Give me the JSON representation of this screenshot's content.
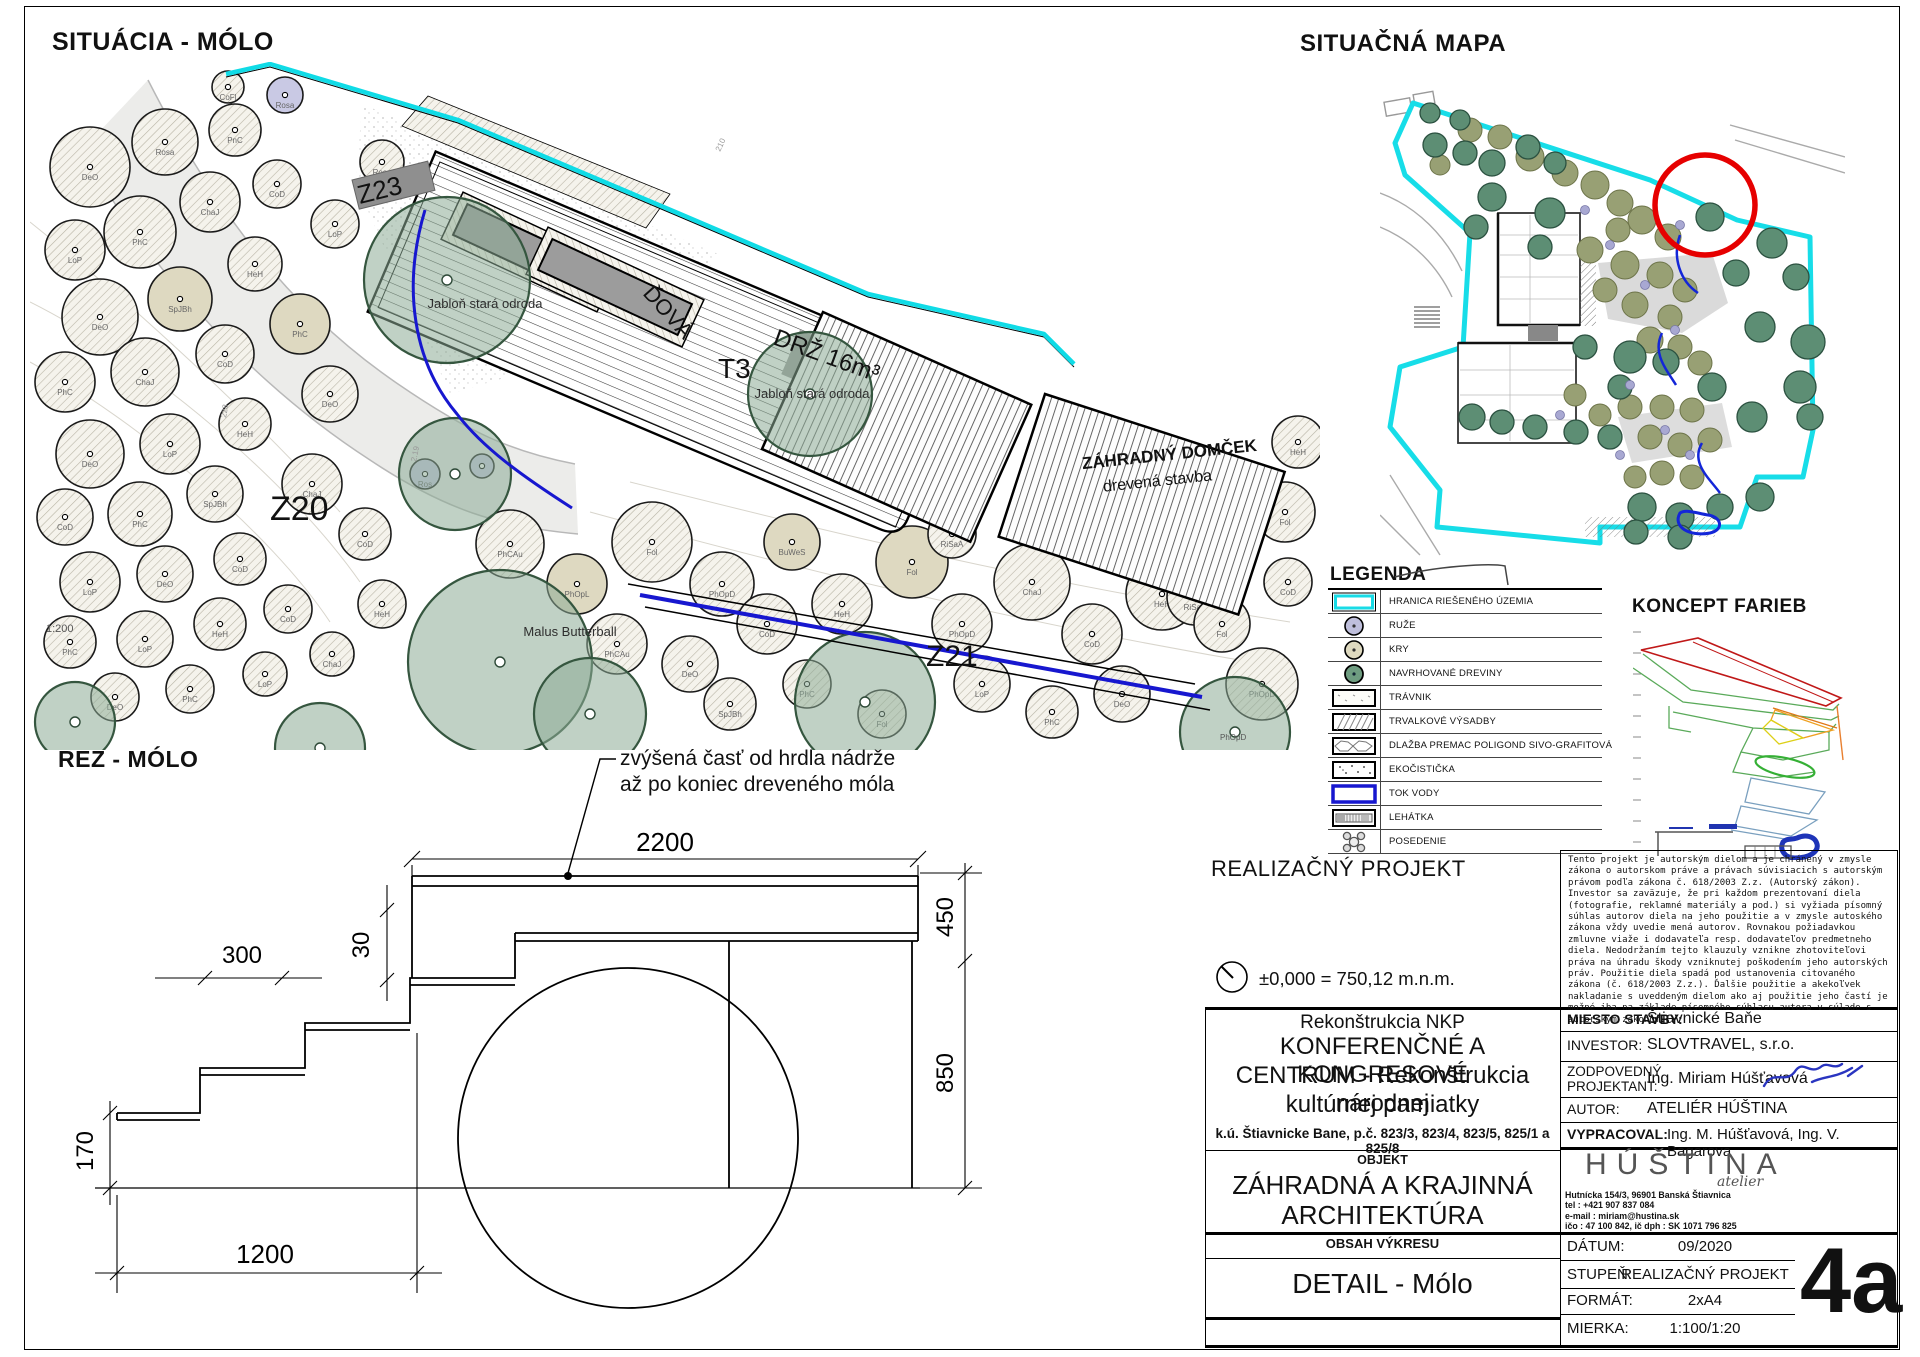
{
  "page": {
    "title_situacia": "SITUÁCIA - MÓLO",
    "title_mapa": "SITUAČNÁ MAPA",
    "title_rez": "REZ - MÓLO",
    "title_legenda": "LEGENDA",
    "title_koncept": "KONCEPT FARIEB"
  },
  "legend": {
    "items": [
      {
        "type": "boundary",
        "icon": "boundary-swatch",
        "label": "HRANICA RIEŠENÉHO ÚZEMIA"
      },
      {
        "type": "rose",
        "icon": "rose-swatch",
        "label": "RUŽE"
      },
      {
        "type": "shrub",
        "icon": "shrub-swatch",
        "label": "KRY"
      },
      {
        "type": "tree",
        "icon": "tree-swatch",
        "label": "NAVRHOVANÉ DREVINY"
      },
      {
        "type": "lawn",
        "icon": "lawn-swatch",
        "label": "TRÁVNIK"
      },
      {
        "type": "perennial",
        "icon": "perennial-swatch",
        "label": "TRVALKOVÉ VÝSADBY"
      },
      {
        "type": "paving",
        "icon": "paving-swatch",
        "label": "DLAŽBA PREMAC POLIGOND SIVO-GRAFITOVÁ"
      },
      {
        "type": "eco",
        "icon": "eco-swatch",
        "label": "EKOČISTIČKA"
      },
      {
        "type": "water",
        "icon": "water-swatch",
        "label": "TOK VODY"
      },
      {
        "type": "lounger",
        "icon": "lounger-swatch",
        "label": "LEHÁTKA"
      },
      {
        "type": "seating",
        "icon": "seating-swatch",
        "label": "POSEDENIE"
      }
    ]
  },
  "plan": {
    "labels": [
      {
        "t": "Z23",
        "x": 330,
        "y": 142,
        "s": 26,
        "r": -14
      },
      {
        "t": "Z20",
        "x": 240,
        "y": 458,
        "s": 34
      },
      {
        "t": "Z21",
        "x": 896,
        "y": 604,
        "s": 30
      },
      {
        "t": "T3",
        "x": 688,
        "y": 316,
        "s": 28
      },
      {
        "t": "ĎOVÁ",
        "x": 612,
        "y": 232,
        "s": 22,
        "r": 48
      },
      {
        "t": "DRŽ  16m³",
        "x": 742,
        "y": 282,
        "s": 24,
        "r": 20
      },
      {
        "t": "ZÁHRADNÝ DOMČEK",
        "x": 1140,
        "y": 398,
        "s": 17,
        "r": -6,
        "a": "m",
        "w": 600
      },
      {
        "t": "drevená stavba",
        "x": 1128,
        "y": 424,
        "s": 16,
        "r": -6,
        "a": "m"
      },
      {
        "t": "1:200",
        "x": 16,
        "y": 570,
        "s": 11,
        "c": "#555"
      },
      {
        "t": "PhOpD",
        "x": 1190,
        "y": 678,
        "s": 8,
        "c": "#555"
      },
      {
        "t": "210",
        "x": 690,
        "y": 90,
        "s": 8,
        "c": "#999",
        "r": -65
      },
      {
        "t": "2.19",
        "x": 386,
        "y": 400,
        "s": 8,
        "c": "#999",
        "r": -78
      },
      {
        "t": "228",
        "x": 196,
        "y": 356,
        "s": 8,
        "c": "#999",
        "r": -80
      }
    ],
    "trees": [
      {
        "x": 60,
        "y": 105,
        "r": 40,
        "l": "DeO"
      },
      {
        "x": 135,
        "y": 80,
        "r": 33,
        "l": "Rosa"
      },
      {
        "x": 205,
        "y": 68,
        "r": 26,
        "l": "PnC"
      },
      {
        "x": 110,
        "y": 170,
        "r": 36,
        "l": "PhC"
      },
      {
        "x": 45,
        "y": 188,
        "r": 30,
        "l": "LoP"
      },
      {
        "x": 180,
        "y": 140,
        "r": 30,
        "l": "ChaJ"
      },
      {
        "x": 247,
        "y": 122,
        "r": 24,
        "l": "CoD"
      },
      {
        "x": 70,
        "y": 255,
        "r": 38,
        "l": "DeO"
      },
      {
        "x": 150,
        "y": 237,
        "r": 32,
        "l": "SpJBh",
        "t": "b"
      },
      {
        "x": 225,
        "y": 202,
        "r": 27,
        "l": "HeH"
      },
      {
        "x": 35,
        "y": 320,
        "r": 30,
        "l": "PhC"
      },
      {
        "x": 115,
        "y": 310,
        "r": 34,
        "l": "ChaJ"
      },
      {
        "x": 195,
        "y": 292,
        "r": 29,
        "l": "CoD"
      },
      {
        "x": 60,
        "y": 392,
        "r": 34,
        "l": "DeO"
      },
      {
        "x": 140,
        "y": 382,
        "r": 30,
        "l": "LoP"
      },
      {
        "x": 215,
        "y": 362,
        "r": 26,
        "l": "HeH"
      },
      {
        "x": 35,
        "y": 455,
        "r": 28,
        "l": "CoD"
      },
      {
        "x": 110,
        "y": 452,
        "r": 32,
        "l": "PhC"
      },
      {
        "x": 185,
        "y": 432,
        "r": 28,
        "l": "SpJBh"
      },
      {
        "x": 60,
        "y": 520,
        "r": 30,
        "l": "LoP"
      },
      {
        "x": 135,
        "y": 512,
        "r": 28,
        "l": "DeO"
      },
      {
        "x": 210,
        "y": 497,
        "r": 26,
        "l": "CoD"
      },
      {
        "x": 40,
        "y": 580,
        "r": 26,
        "l": "PhC"
      },
      {
        "x": 115,
        "y": 577,
        "r": 28,
        "l": "LoP"
      },
      {
        "x": 190,
        "y": 562,
        "r": 26,
        "l": "HeH"
      },
      {
        "x": 258,
        "y": 547,
        "r": 24,
        "l": "CoD"
      },
      {
        "x": 85,
        "y": 635,
        "r": 24,
        "l": "DeO"
      },
      {
        "x": 160,
        "y": 627,
        "r": 24,
        "l": "PhC"
      },
      {
        "x": 235,
        "y": 612,
        "r": 22,
        "l": "LoP"
      },
      {
        "x": 302,
        "y": 592,
        "r": 22,
        "l": "ChaJ"
      },
      {
        "x": 270,
        "y": 262,
        "r": 30,
        "l": "PhC",
        "t": "b"
      },
      {
        "x": 300,
        "y": 332,
        "r": 28,
        "l": "DeO"
      },
      {
        "x": 282,
        "y": 422,
        "r": 30,
        "l": "ChaJ"
      },
      {
        "x": 335,
        "y": 472,
        "r": 26,
        "l": "CoD"
      },
      {
        "x": 352,
        "y": 542,
        "r": 24,
        "l": "HeH"
      },
      {
        "x": 305,
        "y": 162,
        "r": 24,
        "l": "LoP"
      },
      {
        "x": 352,
        "y": 100,
        "r": 22,
        "l": "Rosa"
      },
      {
        "x": 255,
        "y": 33,
        "r": 18,
        "l": "Rosa",
        "t": "r"
      },
      {
        "x": 198,
        "y": 25,
        "r": 16,
        "l": "CoFl"
      },
      {
        "x": 480,
        "y": 482,
        "r": 34,
        "l": "PhCAu"
      },
      {
        "x": 547,
        "y": 522,
        "r": 30,
        "l": "PhOpL",
        "t": "b"
      },
      {
        "x": 622,
        "y": 480,
        "r": 40,
        "l": "Fol"
      },
      {
        "x": 692,
        "y": 522,
        "r": 32,
        "l": "PhOpD"
      },
      {
        "x": 587,
        "y": 582,
        "r": 30,
        "l": "PhCAu"
      },
      {
        "x": 660,
        "y": 602,
        "r": 28,
        "l": "DeO"
      },
      {
        "x": 737,
        "y": 562,
        "r": 30,
        "l": "CoD"
      },
      {
        "x": 762,
        "y": 480,
        "r": 28,
        "l": "BuWeS",
        "t": "b"
      },
      {
        "x": 812,
        "y": 542,
        "r": 30,
        "l": "HeH"
      },
      {
        "x": 882,
        "y": 500,
        "r": 36,
        "l": "Fol",
        "t": "b"
      },
      {
        "x": 932,
        "y": 562,
        "r": 30,
        "l": "PhOpD"
      },
      {
        "x": 1002,
        "y": 520,
        "r": 38,
        "l": "ChaJ"
      },
      {
        "x": 1062,
        "y": 572,
        "r": 30,
        "l": "CoD"
      },
      {
        "x": 1132,
        "y": 532,
        "r": 36,
        "l": "HeH"
      },
      {
        "x": 952,
        "y": 622,
        "r": 28,
        "l": "LoP"
      },
      {
        "x": 1022,
        "y": 650,
        "r": 26,
        "l": "PhC"
      },
      {
        "x": 1092,
        "y": 632,
        "r": 28,
        "l": "DeO"
      },
      {
        "x": 1165,
        "y": 535,
        "r": 28,
        "l": "RiSaA"
      },
      {
        "x": 700,
        "y": 642,
        "r": 26,
        "l": "SpJBh"
      },
      {
        "x": 777,
        "y": 622,
        "r": 24,
        "l": "PhC"
      },
      {
        "x": 852,
        "y": 652,
        "r": 24,
        "l": "Fol"
      },
      {
        "x": 922,
        "y": 472,
        "r": 24,
        "l": "RiSaA"
      },
      {
        "x": 847,
        "y": 427,
        "r": 22,
        "l": "CoM",
        "t": "b"
      },
      {
        "x": 1192,
        "y": 562,
        "r": 28,
        "l": "Fol"
      },
      {
        "x": 1232,
        "y": 622,
        "r": 36,
        "l": "PhOpD"
      },
      {
        "x": 1258,
        "y": 520,
        "r": 24,
        "l": "CoD"
      },
      {
        "x": 1255,
        "y": 450,
        "r": 30,
        "l": "Fol"
      },
      {
        "x": 1268,
        "y": 380,
        "r": 26,
        "l": "HeH"
      },
      {
        "x": 395,
        "y": 412,
        "r": 15,
        "l": "Ros",
        "t": "r"
      },
      {
        "x": 452,
        "y": 404,
        "r": 12,
        "t": "r"
      }
    ],
    "canopies": [
      {
        "x": 417,
        "y": 218,
        "r": 83,
        "l": "Jabloň stará odroda",
        "lx": 455,
        "ly": 246
      },
      {
        "x": 780,
        "y": 332,
        "r": 62,
        "l": "Jabloň stará odroda",
        "lx": 782,
        "ly": 336
      },
      {
        "x": 425,
        "y": 412,
        "r": 56
      },
      {
        "x": 470,
        "y": 600,
        "r": 92,
        "l": "Malus Butterball",
        "lx": 540,
        "ly": 574
      },
      {
        "x": 560,
        "y": 652,
        "r": 56
      },
      {
        "x": 835,
        "y": 640,
        "r": 70
      },
      {
        "x": 290,
        "y": 686,
        "r": 45
      },
      {
        "x": 1205,
        "y": 670,
        "r": 55
      },
      {
        "x": 45,
        "y": 660,
        "r": 40
      }
    ]
  },
  "map": {
    "trees": [
      [
        55,
        60,
        12
      ],
      [
        85,
        68,
        12
      ],
      [
        112,
        78,
        13
      ],
      [
        148,
        62,
        12
      ],
      [
        175,
        78,
        11
      ],
      [
        112,
        112,
        14
      ],
      [
        96,
        142,
        12
      ],
      [
        170,
        128,
        15
      ],
      [
        160,
        162,
        12
      ],
      [
        330,
        132,
        14
      ],
      [
        392,
        158,
        15
      ],
      [
        356,
        188,
        13
      ],
      [
        416,
        192,
        13
      ],
      [
        250,
        272,
        16
      ],
      [
        286,
        277,
        13
      ],
      [
        380,
        242,
        15
      ],
      [
        428,
        257,
        17
      ],
      [
        332,
        302,
        14
      ],
      [
        420,
        302,
        16
      ],
      [
        372,
        332,
        15
      ],
      [
        430,
        332,
        13
      ],
      [
        92,
        332,
        13
      ],
      [
        122,
        337,
        12
      ],
      [
        155,
        342,
        12
      ],
      [
        196,
        347,
        12
      ],
      [
        230,
        352,
        12
      ],
      [
        262,
        422,
        14
      ],
      [
        300,
        432,
        14
      ],
      [
        340,
        422,
        13
      ],
      [
        380,
        412,
        14
      ],
      [
        256,
        447,
        12
      ],
      [
        300,
        452,
        12
      ],
      [
        205,
        262,
        12
      ],
      [
        240,
        302,
        12
      ],
      [
        50,
        28,
        10
      ],
      [
        80,
        35,
        10
      ]
    ],
    "shrubs": [
      [
        150,
        72,
        14
      ],
      [
        185,
        88,
        13
      ],
      [
        215,
        100,
        14
      ],
      [
        240,
        118,
        13
      ],
      [
        262,
        135,
        14
      ],
      [
        288,
        152,
        13
      ],
      [
        238,
        145,
        12
      ],
      [
        210,
        165,
        13
      ],
      [
        245,
        180,
        14
      ],
      [
        280,
        190,
        13
      ],
      [
        305,
        205,
        12
      ],
      [
        225,
        205,
        12
      ],
      [
        255,
        220,
        13
      ],
      [
        290,
        232,
        12
      ],
      [
        270,
        255,
        13
      ],
      [
        300,
        262,
        12
      ],
      [
        320,
        278,
        12
      ],
      [
        250,
        322,
        12
      ],
      [
        282,
        322,
        12
      ],
      [
        312,
        325,
        12
      ],
      [
        270,
        352,
        12
      ],
      [
        300,
        360,
        12
      ],
      [
        330,
        355,
        12
      ],
      [
        282,
        388,
        12
      ],
      [
        312,
        392,
        12
      ],
      [
        255,
        392,
        11
      ],
      [
        90,
        45,
        12
      ],
      [
        120,
        52,
        12
      ],
      [
        60,
        80,
        10
      ],
      [
        195,
        310,
        11
      ],
      [
        220,
        330,
        11
      ]
    ],
    "dots": [
      [
        205,
        125
      ],
      [
        230,
        160
      ],
      [
        265,
        200
      ],
      [
        295,
        245
      ],
      [
        250,
        300
      ],
      [
        285,
        345
      ],
      [
        310,
        370
      ],
      [
        240,
        370
      ],
      [
        180,
        330
      ],
      [
        300,
        140
      ]
    ]
  },
  "section": {
    "annotation_line1": "zvýšená časť od hrdla nádrže",
    "annotation_line2": "až po koniec dreveného móla",
    "dims": {
      "d2200": "2200",
      "d450": "450",
      "d850": "850",
      "d300": "300",
      "d30": "30",
      "d170": "170",
      "d1200": "1200"
    }
  },
  "project": {
    "realizacny": "REALIZAČNÝ PROJEKT",
    "level": "±0,000 = 750,12  m.n.m.",
    "copyright": "Tento projekt je autorským dielom a je chránený v zmysle zákona o autorskom práve a právach súvisiacich s autorským právom podľa zákona č. 618/2003 Z.z. (Autorský zákon). Investor sa zaväzuje, že pri každom prezentovaní diela (fotografie, reklamné materiály a pod.) si vyžiada písomný súhlas autorov diela na jeho použitie a v zmysle autoského zákona vždy uvedie mená autorov. Rovnakou požiadavkou zmluvne viaže i dodavateľa resp. dodavateľov predmetneho diela. Nedodržaním tejto klauzuly vznikne zhotoviteľovi práva na úhradu škody vzniknutej poškodením jeho autorských práv. Použitie diela spadá pod ustanovenia citovaného zákona (č. 618/2003 Z.z.). Ďalšie použitie a akekoľvek nakladanie s uveddeným dielom ako aj použitie jeho častí je možné iba na základe písomného súhlasu autora v súlade s autorským zákonom.",
    "name_line1": "Rekonštrukcia NKP",
    "name_line2": "KONFERENČNÉ A KONGRESOVÉ",
    "name_line3": "CENTRUM - Rekonštrukcia národnej",
    "name_line4": "kultúrnej pamiatky",
    "parcel": "k.ú. Štiavnicke Bane, p.č. 823/3, 823/4, 823/5, 825/1 a 825/8",
    "objekt_header": "OBJEKT",
    "objekt_line1": "ZÁHRADNÁ A KRAJINNÁ",
    "objekt_line2": "ARCHITEKTÚRA",
    "obsah_header": "OBSAH VÝKRESU",
    "obsah_value": "DETAIL - Mólo"
  },
  "titleblock": {
    "rows": [
      {
        "label": "MIESTO STAVBY:",
        "value": "Štiavnické Baňe"
      },
      {
        "label": "INVESTOR:",
        "value": "SLOVTRAVEL, s.r.o."
      },
      {
        "label": "ZODPOVEDNÝ",
        "label2": "PROJEKTANT:",
        "value": "Ing. Miriam Húšťavová"
      },
      {
        "label": "AUTOR:",
        "value": "ATELIÉR HÚŠTINA"
      },
      {
        "label": "VYPRACOVAL:",
        "value": "Ing. M. Húšťavová, Ing. V. Bagarova"
      }
    ],
    "logo": "HÚŠTINA",
    "logo_sub": "atelier",
    "address_lines": [
      "Hutnícka 154/3, 96901 Banská Štiavnica",
      "tel : +421 907 837 084",
      "e-mail : miriam@hustina.sk",
      "ičo : 47 100 842, ič dph : SK 1071 796 825"
    ],
    "meta": [
      {
        "label": "DÁTUM:",
        "value": "09/2020"
      },
      {
        "label": "STUPEŇ:",
        "value": "REALIZAČNÝ PROJEKT"
      },
      {
        "label": "FORMÁT:",
        "value": "2xA4"
      },
      {
        "label": "MIERKA:",
        "value": "1:100/1:20"
      }
    ],
    "sheet_number": "4a"
  }
}
